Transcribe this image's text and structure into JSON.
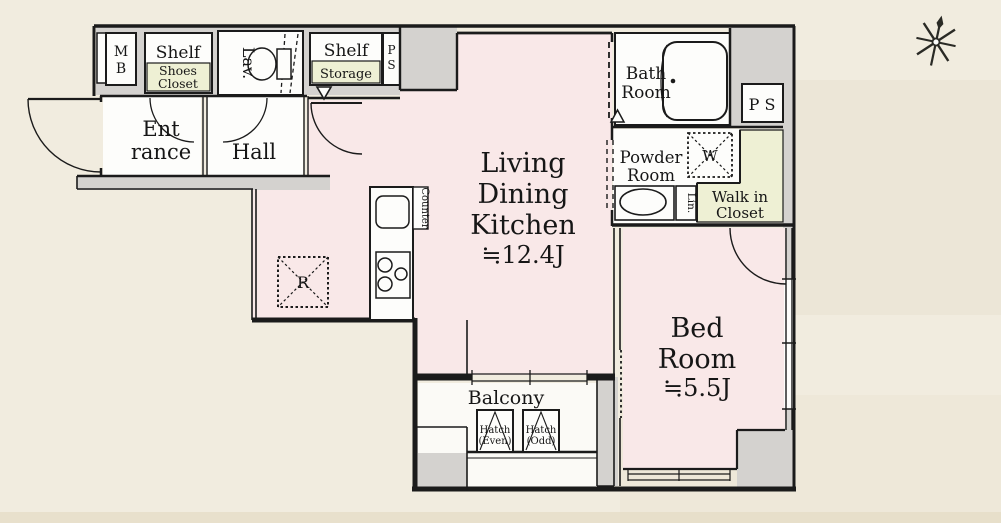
{
  "plan_title": "1LDK apartment floor plan",
  "colors": {
    "room_pink": "#f9e8e8",
    "closet_yellow": "#eef0d4",
    "exterior_gray": "#d4d2cf",
    "background_cream": "#f1ecdf",
    "line_black": "#1b1b1b",
    "fixture_white": "#fdfdfb"
  },
  "rooms": {
    "ldk": {
      "line1": "Living",
      "line2": "Dining",
      "line3": "Kitchen",
      "area": "≒12.4J"
    },
    "bedroom": {
      "line1": "Bed",
      "line2": "Room",
      "area": "≒5.5J"
    },
    "entrance": {
      "line1": "Ent",
      "line2": "rance"
    },
    "hall": {
      "label": "Hall"
    },
    "lav": {
      "label": "Lav."
    },
    "bath": {
      "line1": "Bath",
      "line2": "Room"
    },
    "powder": {
      "line1": "Powder",
      "line2": "Room"
    },
    "wic": {
      "line1": "Walk in",
      "line2": "Closet"
    },
    "balcony": {
      "label": "Balcony"
    }
  },
  "fixtures": {
    "mb": {
      "line1": "M",
      "line2": "B"
    },
    "ps_top": {
      "line1": "P",
      "line2": "S"
    },
    "ps_right": {
      "label": "P S"
    },
    "shelf_left": {
      "label": "Shelf"
    },
    "shoes_closet": {
      "line1": "Shoes",
      "line2": "Closet"
    },
    "shelf_right": {
      "label": "Shelf"
    },
    "storage": {
      "label": "Storage"
    },
    "counter": {
      "label": "Counter"
    },
    "refrigerator": {
      "label": "R"
    },
    "washer": {
      "label": "W"
    },
    "linen": {
      "label": "Lin."
    },
    "hatch_even": {
      "line1": "Hatch",
      "line2": "(Even)"
    },
    "hatch_odd": {
      "line1": "Hatch",
      "line2": "(Odd)"
    }
  },
  "icons": {
    "compass": "compass-star-icon"
  }
}
